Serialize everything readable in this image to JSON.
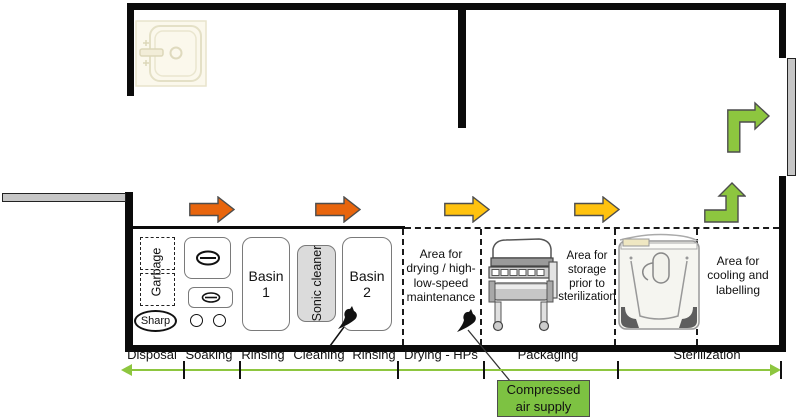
{
  "diagram": {
    "work_area": {
      "garbage_label": "Garbage",
      "sharp_label": "Sharp",
      "basin1_label": "Basin 1",
      "sonic_cleaner_label": "Sonic cleaner",
      "basin2_label": "Basin 2",
      "drying_area_label": [
        "Area for",
        "drying / high-",
        "low-speed",
        "maintenance"
      ],
      "storage_area_label": [
        "Area for",
        "storage",
        "prior to",
        "sterilization"
      ],
      "cooling_area_label": [
        "Area for",
        "cooling and",
        "labelling"
      ]
    },
    "stages": [
      "Disposal",
      "Soaking",
      "Rinsing",
      "Cleaning",
      "Rinsing",
      "Drying - HPs",
      "Packaging",
      "Sterilization"
    ],
    "compressed_air_label": [
      "Compressed",
      "air supply"
    ],
    "icons": {
      "sink": "sink-illustration",
      "packaging_machine": "pouch-sealer-illustration",
      "sterilizer": "autoclave-illustration",
      "air_gun": "compressed-air-gun-icon"
    },
    "colors": {
      "flow_arrow_orange": "#E8650D",
      "flow_arrow_yellow": "#FFC20E",
      "flow_arrow_green": "#8DC63F",
      "stage_line_green": "#8DC63F",
      "air_supply_box_green": "#7DC242",
      "sonic_cleaner_fill": "#DBDBDB",
      "wall_black": "#0B0B0B"
    }
  }
}
